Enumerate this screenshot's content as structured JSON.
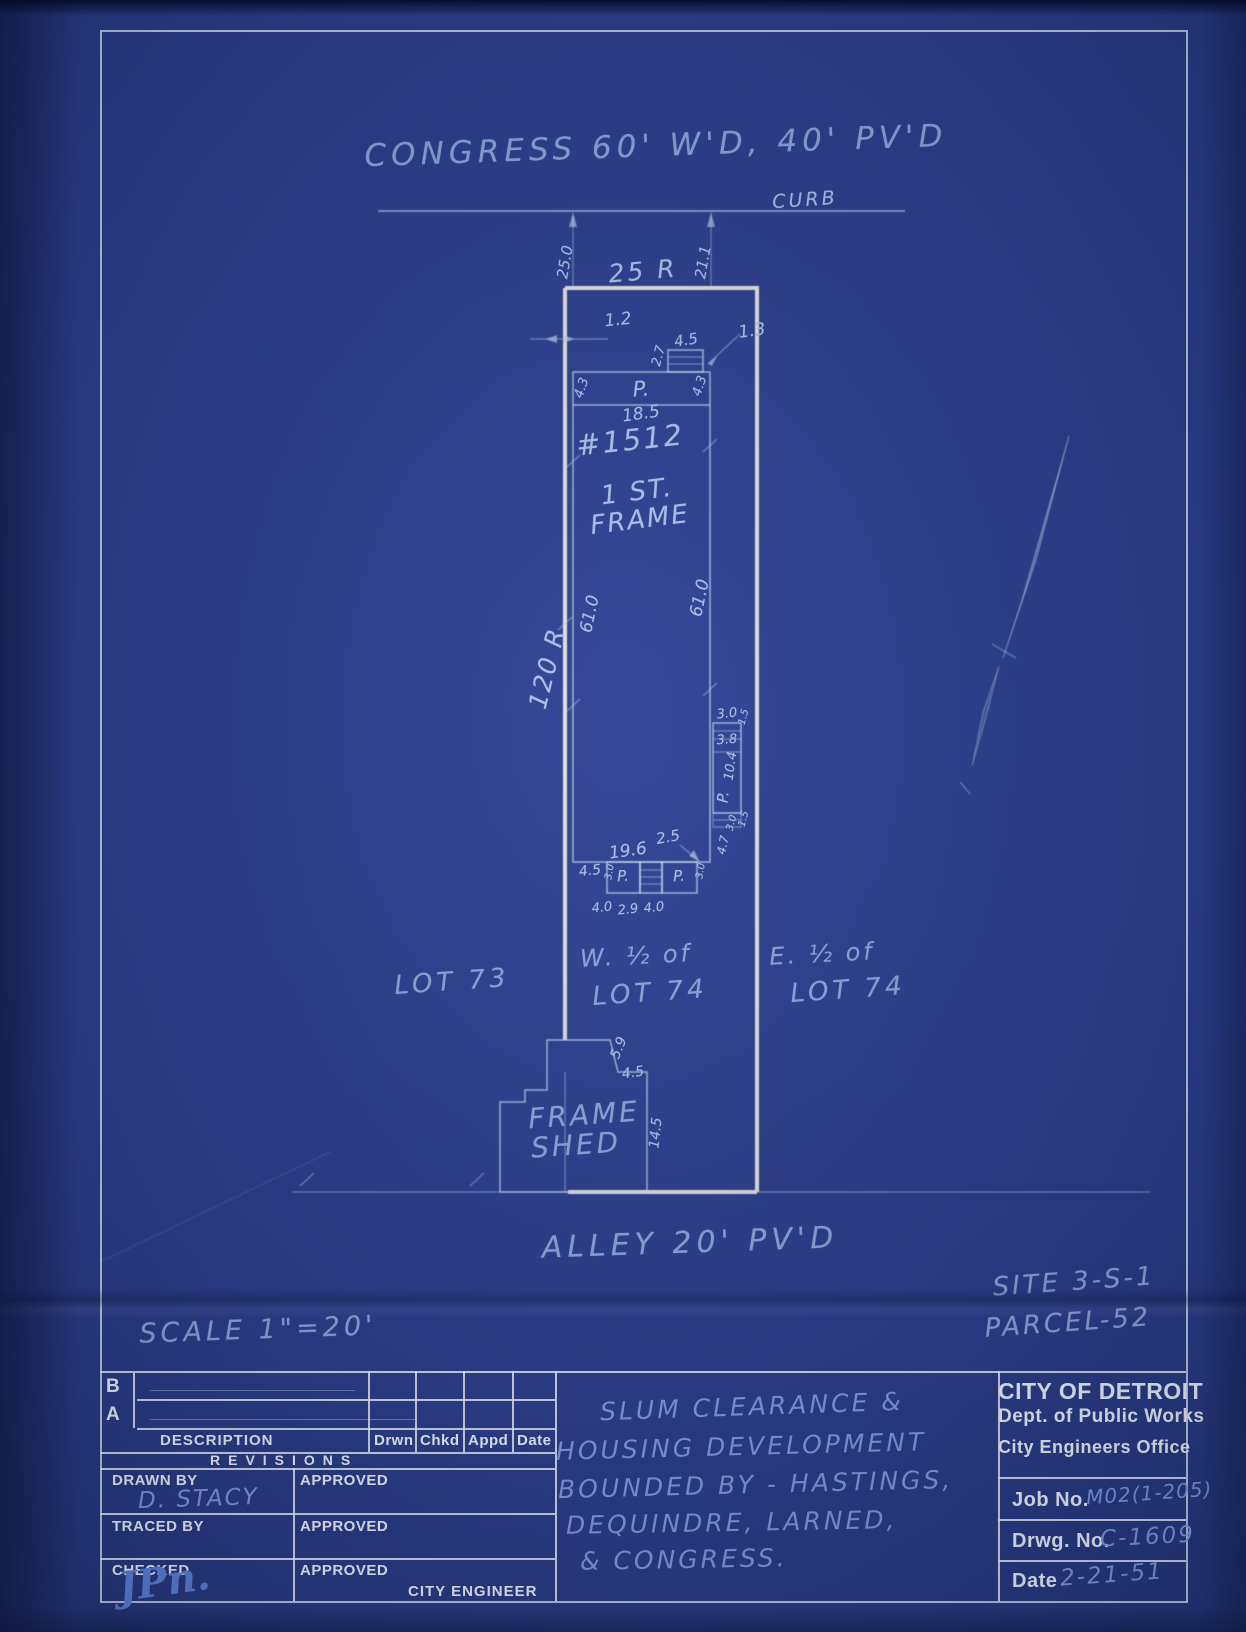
{
  "palette": {
    "paper": "#2a3c8a",
    "thin_line": "#c1d0f0",
    "bold_line": "#f1ede0",
    "hand_text": "#abc0ea",
    "pencil_text": "#7e9ade",
    "print_text": "#edf2fb"
  },
  "plan": {
    "annotations": [
      {
        "n": "street-label",
        "t": "CONGRESS 60' W'D, 40' PV'D",
        "x": 656,
        "y": 146,
        "s": 31,
        "r": -2,
        "c": "faint",
        "ls": 5
      },
      {
        "n": "curb-label",
        "t": "CURB",
        "x": 805,
        "y": 200,
        "s": 19,
        "r": -4,
        "c": "hand",
        "ls": 3
      },
      {
        "n": "dim-25-0",
        "t": "25.0",
        "x": 565,
        "y": 262,
        "s": 15,
        "r": -80,
        "c": "hand"
      },
      {
        "n": "dim-21-1",
        "t": "21.1",
        "x": 703,
        "y": 262,
        "s": 15,
        "r": -80,
        "c": "hand"
      },
      {
        "n": "dim-25r",
        "t": "25 R",
        "x": 643,
        "y": 271,
        "s": 25,
        "r": -5,
        "c": "hand",
        "ls": 3
      },
      {
        "n": "dim-1-2",
        "t": "1.2",
        "x": 618,
        "y": 320,
        "s": 17,
        "r": -6,
        "c": "hand"
      },
      {
        "n": "dim-4-5-steps",
        "t": "4.5",
        "x": 686,
        "y": 340,
        "s": 15,
        "r": -9,
        "c": "hand"
      },
      {
        "n": "dim-2-7",
        "t": "2.7",
        "x": 659,
        "y": 356,
        "s": 13,
        "r": -75,
        "c": "hand"
      },
      {
        "n": "dim-1-3",
        "t": "1.3",
        "x": 752,
        "y": 331,
        "s": 17,
        "r": -8,
        "c": "hand"
      },
      {
        "n": "porch-label-top",
        "t": "P.",
        "x": 641,
        "y": 389,
        "s": 21,
        "r": -4,
        "c": "hand"
      },
      {
        "n": "dim-4-3-left",
        "t": "4.3",
        "x": 582,
        "y": 388,
        "s": 13,
        "r": -72,
        "c": "hand"
      },
      {
        "n": "dim-4-3-right",
        "t": "4.3",
        "x": 700,
        "y": 386,
        "s": 13,
        "r": -72,
        "c": "hand"
      },
      {
        "n": "dim-18-5",
        "t": "18.5",
        "x": 641,
        "y": 414,
        "s": 17,
        "r": -8,
        "c": "hand"
      },
      {
        "n": "house-number",
        "t": "#1512",
        "x": 630,
        "y": 440,
        "s": 29,
        "r": -6,
        "c": "hand",
        "ls": 2
      },
      {
        "n": "house-story",
        "t": "1 ST.",
        "x": 637,
        "y": 492,
        "s": 26,
        "r": -7,
        "c": "hand",
        "ls": 2
      },
      {
        "n": "house-material",
        "t": "FRAME",
        "x": 640,
        "y": 520,
        "s": 26,
        "r": -7,
        "c": "hand",
        "ls": 2
      },
      {
        "n": "dim-61-0-left",
        "t": "61.0",
        "x": 590,
        "y": 614,
        "s": 17,
        "r": -78,
        "c": "hand"
      },
      {
        "n": "dim-61-0-right",
        "t": "61.0",
        "x": 700,
        "y": 598,
        "s": 17,
        "r": -78,
        "c": "hand"
      },
      {
        "n": "dim-120r",
        "t": "120 R",
        "x": 547,
        "y": 668,
        "s": 25,
        "r": -76,
        "c": "hand",
        "ls": 2
      },
      {
        "n": "dim-3-0-e",
        "t": "3.0",
        "x": 727,
        "y": 714,
        "s": 13,
        "r": -6,
        "c": "hand"
      },
      {
        "n": "dim-1-5-e",
        "t": "1.5",
        "x": 744,
        "y": 717,
        "s": 10,
        "r": -75,
        "c": "hand"
      },
      {
        "n": "dim-3-8",
        "t": "3.8",
        "x": 727,
        "y": 740,
        "s": 13,
        "r": -4,
        "c": "hand"
      },
      {
        "n": "dim-10-4",
        "t": "10.4",
        "x": 731,
        "y": 766,
        "s": 13,
        "r": -82,
        "c": "hand"
      },
      {
        "n": "porch-label-east",
        "t": "P.",
        "x": 723,
        "y": 797,
        "s": 15,
        "r": -85,
        "c": "hand"
      },
      {
        "n": "dim-3-0-e2",
        "t": "3.0",
        "x": 732,
        "y": 823,
        "s": 10,
        "r": -75,
        "c": "hand"
      },
      {
        "n": "dim-1-5-e2",
        "t": "1.5",
        "x": 744,
        "y": 819,
        "s": 10,
        "r": -75,
        "c": "hand"
      },
      {
        "n": "dim-4-7-e",
        "t": "4.7",
        "x": 723,
        "y": 845,
        "s": 12,
        "r": -78,
        "c": "hand"
      },
      {
        "n": "dim-2-5",
        "t": "2.5",
        "x": 668,
        "y": 837,
        "s": 15,
        "r": -10,
        "c": "hand"
      },
      {
        "n": "dim-19-6",
        "t": "19.6",
        "x": 628,
        "y": 851,
        "s": 17,
        "r": -8,
        "c": "hand"
      },
      {
        "n": "dim-4-5-south",
        "t": "4.5",
        "x": 590,
        "y": 871,
        "s": 14,
        "r": -6,
        "c": "hand"
      },
      {
        "n": "porch-label-s1",
        "t": "P.",
        "x": 623,
        "y": 876,
        "s": 15,
        "r": -3,
        "c": "hand"
      },
      {
        "n": "porch-label-s2",
        "t": "P.",
        "x": 679,
        "y": 876,
        "s": 15,
        "r": -3,
        "c": "hand"
      },
      {
        "n": "dim-3-0-s1",
        "t": "3.0",
        "x": 610,
        "y": 872,
        "s": 10,
        "r": -80,
        "c": "hand"
      },
      {
        "n": "dim-3-0-s2",
        "t": "3.0",
        "x": 701,
        "y": 871,
        "s": 10,
        "r": -80,
        "c": "hand"
      },
      {
        "n": "dim-4-0-a",
        "t": "4.0",
        "x": 602,
        "y": 908,
        "s": 13,
        "r": -6,
        "c": "hand"
      },
      {
        "n": "dim-2-9",
        "t": "2.9",
        "x": 628,
        "y": 910,
        "s": 13,
        "r": -6,
        "c": "hand"
      },
      {
        "n": "dim-4-0-b",
        "t": "4.0",
        "x": 654,
        "y": 908,
        "s": 13,
        "r": -6,
        "c": "hand"
      },
      {
        "n": "lot73-label",
        "t": "LOT 73",
        "x": 452,
        "y": 982,
        "s": 26,
        "r": -4,
        "c": "faint",
        "ls": 4
      },
      {
        "n": "w-half-label",
        "t": "W. ½ of",
        "x": 636,
        "y": 956,
        "s": 24,
        "r": -3,
        "c": "faint",
        "ls": 3
      },
      {
        "n": "lot74w-label",
        "t": "LOT 74",
        "x": 650,
        "y": 993,
        "s": 26,
        "r": -4,
        "c": "faint",
        "ls": 4
      },
      {
        "n": "e-half-label",
        "t": "E. ½ of",
        "x": 822,
        "y": 954,
        "s": 24,
        "r": -3,
        "c": "faint",
        "ls": 3
      },
      {
        "n": "lot74e-label",
        "t": "LOT 74",
        "x": 848,
        "y": 990,
        "s": 26,
        "r": -4,
        "c": "faint",
        "ls": 4
      },
      {
        "n": "dim-5-9",
        "t": "5.9",
        "x": 619,
        "y": 1048,
        "s": 14,
        "r": -68,
        "c": "hand"
      },
      {
        "n": "dim-4-5-shed",
        "t": "4.5",
        "x": 633,
        "y": 1073,
        "s": 14,
        "r": -8,
        "c": "hand"
      },
      {
        "n": "shed-label-1",
        "t": "FRAME",
        "x": 584,
        "y": 1115,
        "s": 28,
        "r": -4,
        "c": "faint",
        "ls": 3
      },
      {
        "n": "shed-label-2",
        "t": "SHED",
        "x": 576,
        "y": 1145,
        "s": 28,
        "r": -4,
        "c": "faint",
        "ls": 3
      },
      {
        "n": "dim-14-5",
        "t": "14.5",
        "x": 656,
        "y": 1133,
        "s": 14,
        "r": -84,
        "c": "hand"
      },
      {
        "n": "alley-label",
        "t": "ALLEY  20' PV'D",
        "x": 690,
        "y": 1243,
        "s": 30,
        "r": -2,
        "c": "faint",
        "ls": 5
      },
      {
        "n": "site-label",
        "t": "SITE 3-S-1",
        "x": 1074,
        "y": 1282,
        "s": 26,
        "r": -4,
        "c": "faint",
        "ls": 3
      },
      {
        "n": "parcel-label",
        "t": "PARCEL-52",
        "x": 1068,
        "y": 1323,
        "s": 26,
        "r": -4,
        "c": "faint",
        "ls": 3
      },
      {
        "n": "scale-label",
        "t": "SCALE  1\"=20'",
        "x": 258,
        "y": 1330,
        "s": 27,
        "r": -2,
        "c": "faint",
        "ls": 4
      }
    ]
  },
  "titleblock": {
    "revisions": {
      "row_b": "B",
      "row_a": "A",
      "description": "DESCRIPTION",
      "cols": [
        "Drwn",
        "Chkd",
        "Appd",
        "Date"
      ],
      "title": "REVISIONS"
    },
    "signoff": {
      "drawn_by_label": "DRAWN BY",
      "drawn_by_value": "D. STACY",
      "traced_by_label": "TRACED BY",
      "checked_label": "CHECKED",
      "checked_value": "JPn.",
      "approved_label": "APPROVED",
      "city_engineer_label": "CITY ENGINEER"
    },
    "project": {
      "lines": [
        "SLUM  CLEARANCE  &",
        "HOUSING  DEVELOPMENT",
        "BOUNDED  BY - HASTINGS,",
        "DEQUINDRE,  LARNED,",
        "&  CONGRESS."
      ]
    },
    "agency": {
      "line1": "CITY OF DETROIT",
      "line2": "Dept. of Public Works",
      "line3": "City Engineers Office",
      "job_label": "Job No.",
      "job_value": "M02(1-205)",
      "drwg_label": "Drwg. No.",
      "drwg_value": "C-1609",
      "date_label": "Date",
      "date_value": "2-21-51"
    }
  }
}
